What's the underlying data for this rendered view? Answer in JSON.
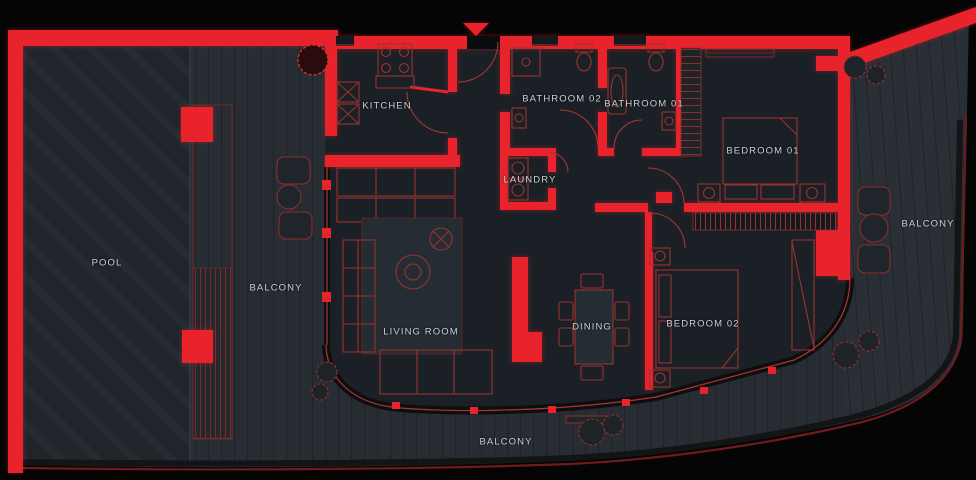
{
  "plan": {
    "rooms": {
      "pool": "POOL",
      "balcony_left": "BALCONY",
      "kitchen": "KITCHEN",
      "bathroom_02": "BATHROOM 02",
      "bathroom_01": "BATHROOM 01",
      "laundry": "LAUNDRY",
      "bedroom_01": "BEDROOM 01",
      "bedroom_02": "BEDROOM 02",
      "living_room": "LIVING ROOM",
      "dining": "DINING",
      "balcony_right": "BALCONY",
      "balcony_bottom": "BALCONY"
    },
    "colors": {
      "wall_accent": "#e8232b",
      "furniture_outline": "#98342f",
      "deck_floor": "#282d34",
      "pool_water": "#20252c",
      "interior_floor": "#1b2026",
      "background": "#050505",
      "label_text": "#ccd1d6",
      "site_edge": "#6f1b1d"
    },
    "icons": {
      "entry_marker": "▼"
    }
  }
}
